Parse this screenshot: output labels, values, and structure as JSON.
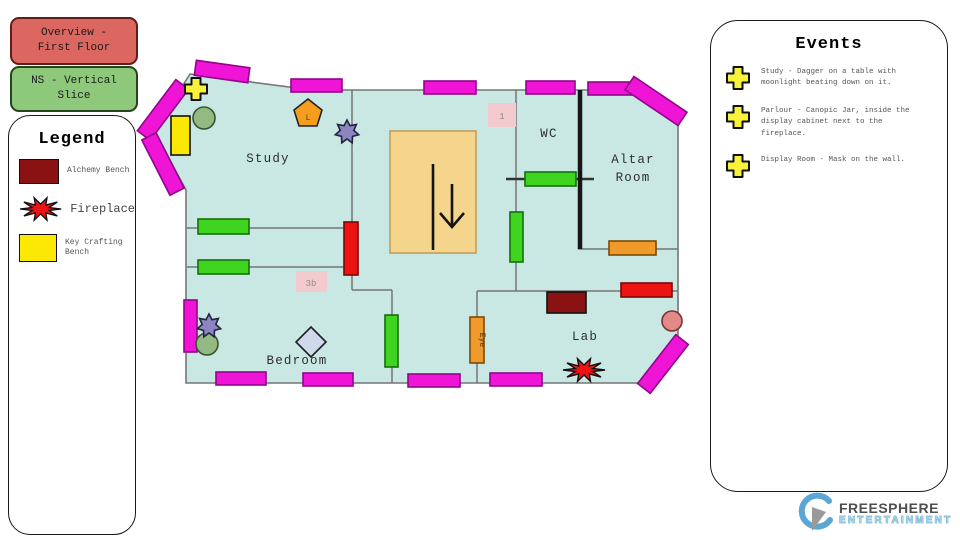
{
  "tabs": {
    "overview_label": "Overview - First Floor",
    "slice_label": "NS - Vertical Slice"
  },
  "legend": {
    "title": "Legend",
    "items": [
      {
        "icon": "alchemy-bench-swatch",
        "label": "Alchemy Bench",
        "color": "#8b1212"
      },
      {
        "icon": "fireplace-starburst",
        "label": "Fireplace",
        "color": "#ee1313"
      },
      {
        "icon": "key-crafting-bench-swatch",
        "label": "Key Crafting Bench",
        "color": "#fce903"
      }
    ]
  },
  "events": {
    "title": "Events",
    "items": [
      {
        "icon": "plus-icon",
        "text": "Study - Dagger on a table with moonlight beating down on it."
      },
      {
        "icon": "plus-icon",
        "text": "Parlour - Canopic Jar, inside the display cabinet next to the fireplace."
      },
      {
        "icon": "plus-icon",
        "text": "Display Room - Mask on the wall."
      }
    ]
  },
  "floorplan": {
    "rooms": {
      "study": "Study",
      "wc": "WC",
      "altar_line1": "Altar",
      "altar_line2": "Room",
      "bedroom": "Bedroom",
      "lab": "Lab"
    },
    "markers": {
      "stair_label": "1",
      "corridor_label": "3b",
      "lantern_label": "L",
      "eye_label": "Eye"
    },
    "colors": {
      "floor": "#c9e7e3",
      "wall_line": "#767676",
      "window_magenta": "#f014d6",
      "door_green": "#3fd41f",
      "door_red": "#ee1313",
      "door_orange": "#f19a2c",
      "alchemy_bench": "#8b1212",
      "key_bench_yellow": "#fce903",
      "staircase_tan": "#f5d48b",
      "event_plus_yellow": "#f8f23a"
    }
  },
  "logo": {
    "name": "FREESPHERE",
    "subtitle": "ENTERTAINMENT"
  }
}
